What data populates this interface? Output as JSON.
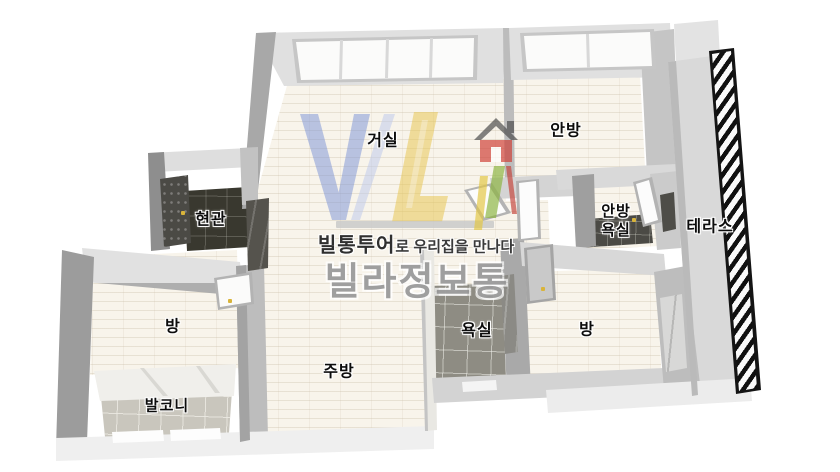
{
  "rooms": {
    "living": {
      "label": "거실"
    },
    "master": {
      "label": "안방"
    },
    "entrance": {
      "label": "현관"
    },
    "master_bath": {
      "line1": "안방",
      "line2": "욕실"
    },
    "terrace": {
      "label": "테라스"
    },
    "room_left": {
      "label": "방"
    },
    "balcony": {
      "label": "발코니"
    },
    "kitchen": {
      "label": "주방"
    },
    "bathroom": {
      "label": "욕실"
    },
    "room_right": {
      "label": "방"
    }
  },
  "watermark": {
    "logo_letters": "VL",
    "tagline_brand": "빌통투어",
    "tagline_rest": "로 우리집을 만나다",
    "brand_large": "빌라정보통",
    "colors": {
      "logo_blue": "#7e95d6",
      "logo_light_blue": "#bdc9eb",
      "logo_yellow": "#e7c54f",
      "house_red": "#cf3e36",
      "house_green": "#8cb440",
      "house_roof": "#4a4a4a"
    }
  }
}
